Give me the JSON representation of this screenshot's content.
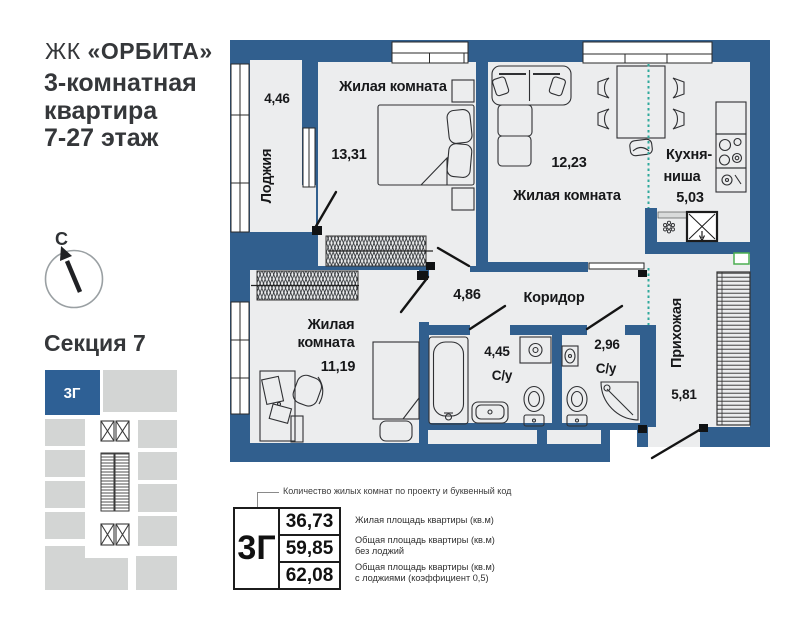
{
  "header": {
    "complex_prefix": "ЖК",
    "complex_name": "«ОРБИТА»",
    "title_line1": "3-комнатная",
    "title_line2": "квартира",
    "title_line3": "7-27 этаж"
  },
  "compass": {
    "north_label": "С"
  },
  "section": {
    "title": "Секция 7",
    "highlight_unit": "3Г"
  },
  "floor_plan": {
    "rooms": {
      "loggia": {
        "name": "Лоджия",
        "area": "4,46"
      },
      "living_top_left": {
        "name": "Жилая комната",
        "area": "13,31"
      },
      "living_top_right": {
        "name": "Жилая комната",
        "area": "12,23"
      },
      "kitchen": {
        "name_line1": "Кухня-",
        "name_line2": "ниша",
        "area": "5,03"
      },
      "corridor": {
        "name": "Коридор",
        "area": "4,86"
      },
      "living_bottom": {
        "name_line1": "Жилая",
        "name_line2": "комната",
        "area": "11,19"
      },
      "bathroom_large": {
        "name": "С/у",
        "area": "4,45"
      },
      "bathroom_small": {
        "name": "С/у",
        "area": "2,96"
      },
      "hallway": {
        "name": "Прихожая",
        "area": "5,81"
      }
    }
  },
  "summary": {
    "annotation": "Количество жилых комнат по проекту и буквенный код",
    "unit_code": "3Г",
    "rows": [
      {
        "value": "36,73",
        "label_line1": "Жилая площадь квартиры (кв.м)",
        "label_line2": ""
      },
      {
        "value": "59,85",
        "label_line1": "Общая площадь квартиры (кв.м)",
        "label_line2": "без лоджий"
      },
      {
        "value": "62,08",
        "label_line1": "Общая площадь квартиры (кв.м)",
        "label_line2": "с лоджиями (коэффициент 0,5)"
      }
    ]
  },
  "colors": {
    "wall_blue": "#315f8e",
    "room_fill": "#ecedee",
    "block_gray": "#d3d5d4",
    "accent_teal": "#2fa99c",
    "vent_green": "#4caf50"
  }
}
